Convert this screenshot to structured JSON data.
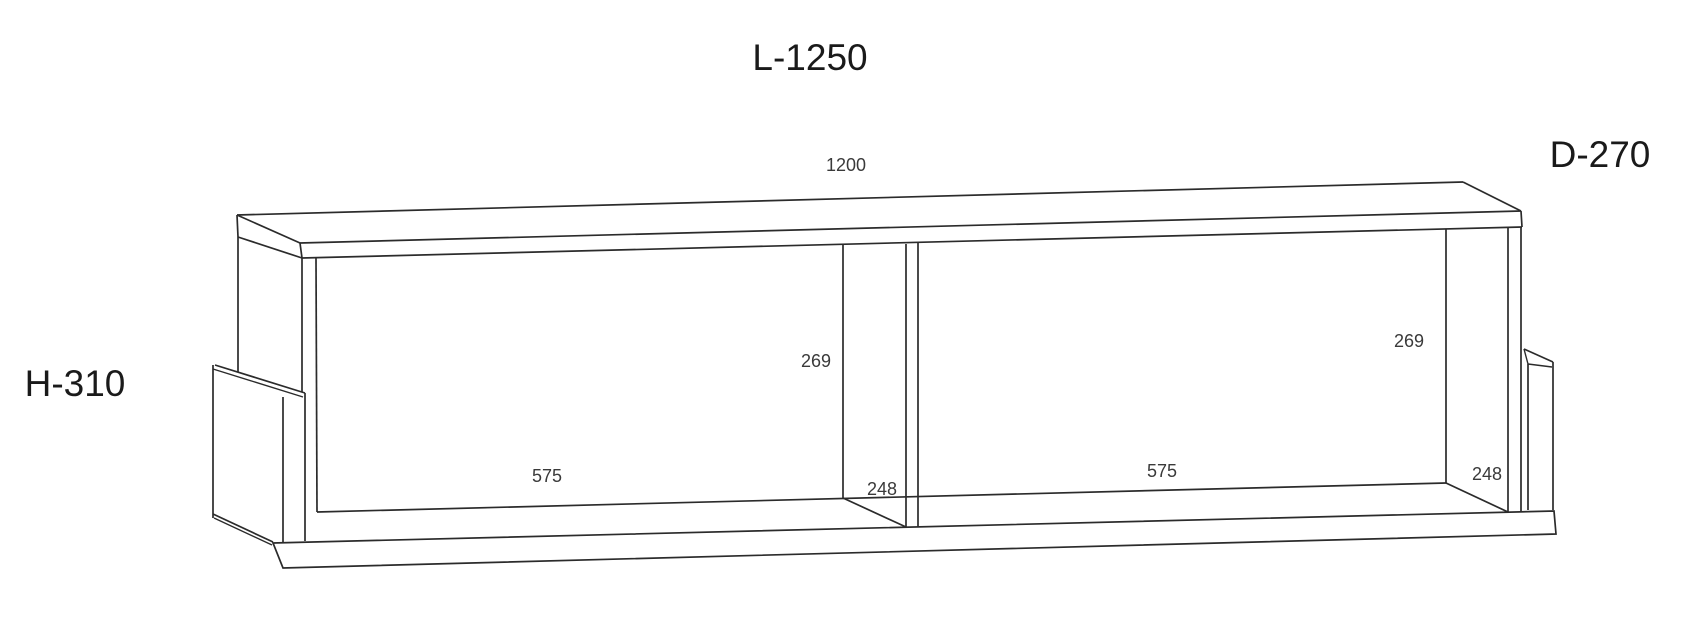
{
  "diagram": {
    "type": "furniture-technical-drawing",
    "description": "Wall-mounted shelf with two open compartments, central divider and two rear hanging brackets, shown in oblique projection with dimensions in millimetres",
    "labels": {
      "overall_length": "L-1250",
      "overall_depth": "D-270",
      "overall_height": "H-310",
      "interior_width": "1200",
      "left_inner_height": "269",
      "right_inner_height": "269",
      "left_compartment_width": "575",
      "right_compartment_width": "575",
      "left_inner_depth": "248",
      "right_inner_depth": "248"
    },
    "colors": {
      "background": "#ffffff",
      "line": "#2b2b2b",
      "label_primary": "#1a1a1a",
      "label_secondary": "#3a3a3a"
    }
  }
}
